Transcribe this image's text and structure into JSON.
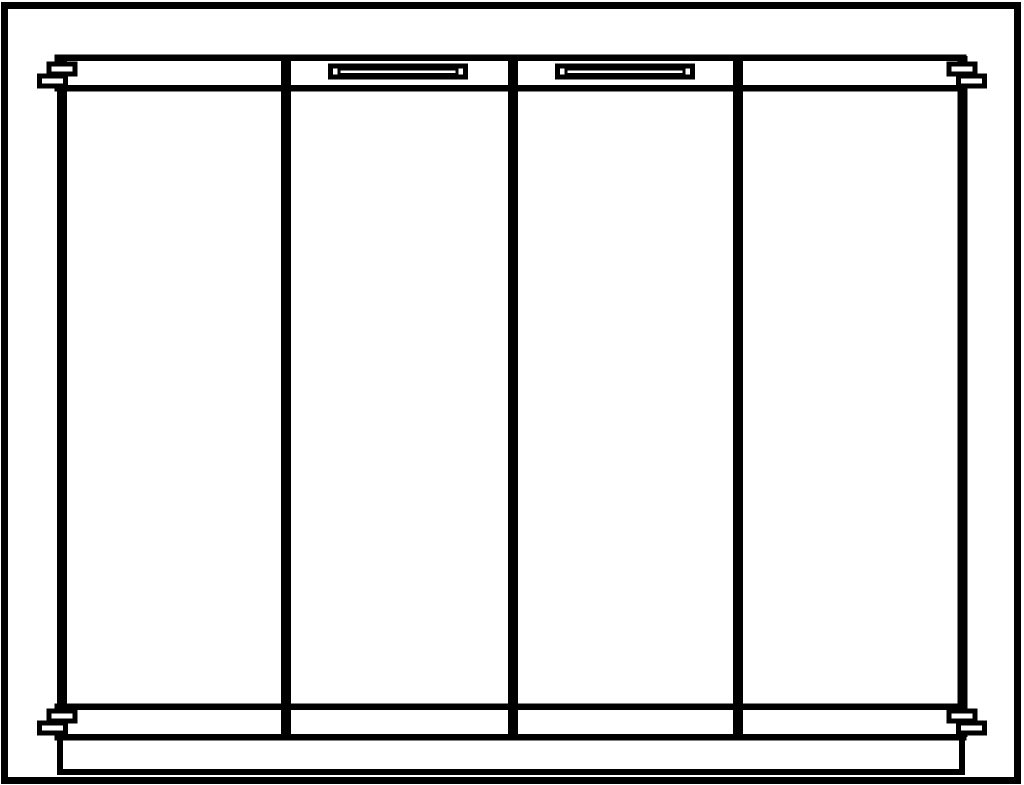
{
  "meta": {
    "subject": "four-panel-bifold-door-front-elevation",
    "style": "black-and-white-line-drawing"
  },
  "drawing": {
    "canvas": {
      "width": 1024,
      "height": 785
    },
    "line_color": "#000000",
    "background": "#ffffff",
    "panel_count": 4,
    "outer_frame": {
      "x": 1,
      "y": 2,
      "w": 1020,
      "h": 782,
      "sw": 7
    },
    "base_plate": {
      "x": 57,
      "y": 734,
      "w": 908,
      "h": 41,
      "sw": 6
    },
    "top_rail": {
      "x": 54.5,
      "y": 54.5,
      "w": 912,
      "h": 37,
      "sw": 6.5
    },
    "bottom_rail": {
      "x": 54.5,
      "y": 703.5,
      "w": 912,
      "h": 37,
      "sw": 6.5
    },
    "stiles": [
      {
        "name": "left-stile",
        "x": 62,
        "y1": 56,
        "y2": 737,
        "sw": 10
      },
      {
        "name": "panel-divider-1",
        "x": 286,
        "y1": 55,
        "y2": 740,
        "sw": 10
      },
      {
        "name": "panel-divider-2",
        "x": 513,
        "y1": 55,
        "y2": 740,
        "sw": 10
      },
      {
        "name": "panel-divider-3",
        "x": 738,
        "y1": 55,
        "y2": 740,
        "sw": 10
      },
      {
        "name": "right-stile",
        "x": 962.5,
        "y1": 56,
        "y2": 737,
        "sw": 10
      }
    ],
    "handles": [
      {
        "name": "handle-left",
        "outer": {
          "x": 328,
          "y": 63.5,
          "w": 140,
          "h": 16,
          "sw": 5
        },
        "slot": {
          "x": 337.5,
          "y": 67.5,
          "w": 121,
          "h": 8.5,
          "sw": 3
        }
      },
      {
        "name": "handle-right",
        "outer": {
          "x": 555,
          "y": 63.5,
          "w": 140,
          "h": 16,
          "sw": 5
        },
        "slot": {
          "x": 564.5,
          "y": 67.5,
          "w": 121,
          "h": 8.5,
          "sw": 3
        }
      }
    ],
    "hinge_pins": [
      {
        "name": "hinge-pin-top-left",
        "sw": 5,
        "rects": [
          {
            "x": 46.5,
            "y": 61.5,
            "w": 31,
            "h": 15
          },
          {
            "x": 37,
            "y": 73.5,
            "w": 31,
            "h": 15
          }
        ]
      },
      {
        "name": "hinge-pin-top-right",
        "sw": 5,
        "rects": [
          {
            "x": 946.5,
            "y": 61.5,
            "w": 31,
            "h": 15
          },
          {
            "x": 956,
            "y": 73.5,
            "w": 31,
            "h": 15
          }
        ]
      },
      {
        "name": "hinge-pin-bottom-left",
        "sw": 5,
        "rects": [
          {
            "x": 46.5,
            "y": 708.5,
            "w": 31,
            "h": 15
          },
          {
            "x": 37,
            "y": 720.5,
            "w": 31,
            "h": 15
          }
        ]
      },
      {
        "name": "hinge-pin-bottom-right",
        "sw": 5,
        "rects": [
          {
            "x": 946.5,
            "y": 708.5,
            "w": 31,
            "h": 15
          },
          {
            "x": 956,
            "y": 720.5,
            "w": 31,
            "h": 15
          }
        ]
      }
    ]
  }
}
